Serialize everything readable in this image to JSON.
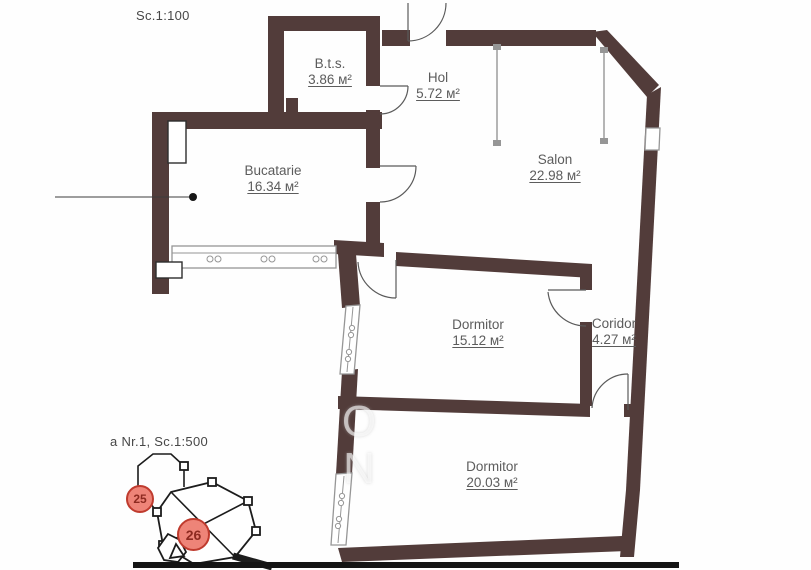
{
  "texts": {
    "scale_top": "Sc.1:100",
    "scale_bottom": "a Nr.1, Sc.1:500"
  },
  "rooms": [
    {
      "id": "bts",
      "name": "B.t.s.",
      "area": "3.86 м²"
    },
    {
      "id": "hol",
      "name": "Hol",
      "area": "5.72 м²"
    },
    {
      "id": "salon",
      "name": "Salon",
      "area": "22.98 м²"
    },
    {
      "id": "bucatarie",
      "name": "Bucatarie",
      "area": "16.34 м²"
    },
    {
      "id": "dormitor-1",
      "name": "Dormitor",
      "area": "15.12 м²"
    },
    {
      "id": "coridor",
      "name": "Coridor",
      "area": "4.27 м²"
    },
    {
      "id": "dormitor-2",
      "name": "Dormitor",
      "area": "20.03 м²"
    }
  ],
  "site_plan": {
    "badges": [
      {
        "label": "25"
      },
      {
        "label": "26"
      }
    ]
  },
  "watermark": {
    "letters": [
      "O",
      "N"
    ]
  },
  "colors": {
    "wall": "#523c3a",
    "line": "#969696",
    "label": "#5c5c5c",
    "site_outline": "#1c1c1c",
    "badge_fill": "#ee8478",
    "badge_border": "#bf3b2e",
    "badge_text": "#8d2a20"
  }
}
